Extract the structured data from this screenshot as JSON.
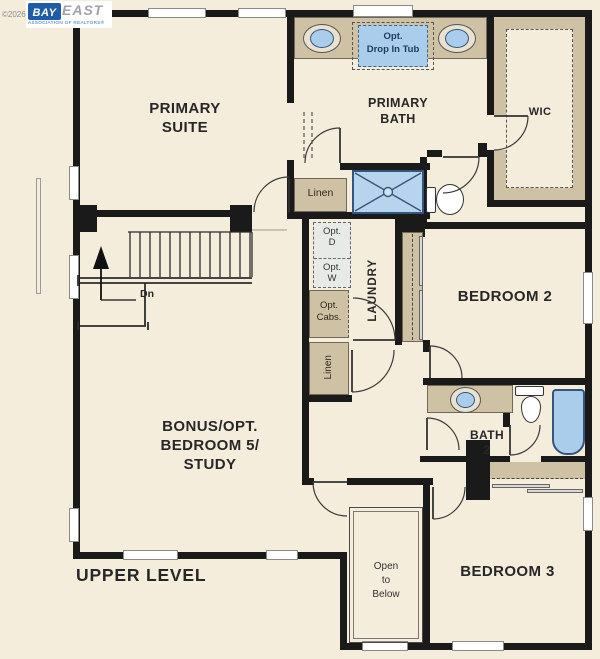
{
  "colors": {
    "background": "#f5eddc",
    "wall": "#1a1a1a",
    "counter_tan": "#cfc2a4",
    "fixture_blue": "#abcdec",
    "fixture_outline": "#35567a",
    "logo_blue": "#1f5ca8",
    "logo_gray": "#9fa3a8",
    "label_color": "#272727"
  },
  "logo": {
    "year": "©2026",
    "brand_primary": "BAY",
    "brand_secondary": "EAST",
    "tagline": "ASSOCIATION OF REALTORS®"
  },
  "level_label": "UPPER LEVEL",
  "rooms": {
    "primary_suite": [
      "PRIMARY",
      "SUITE"
    ],
    "primary_bath": [
      "PRIMARY",
      "BATH"
    ],
    "wic": "WIC",
    "bedroom2": "BEDROOM 2",
    "bath2": [
      "BATH",
      "2"
    ],
    "bedroom3": "BEDROOM 3",
    "bonus": [
      "BONUS/OPT.",
      "BEDROOM 5/",
      "STUDY"
    ],
    "laundry": "LAUNDRY",
    "open_to_below": [
      "Open",
      "to",
      "Below"
    ]
  },
  "closets": {
    "linen_upper": "Linen",
    "linen_lower": "Linen"
  },
  "options": {
    "drop_in_tub": [
      "Opt.",
      "Drop In Tub"
    ],
    "dryer": [
      "Opt.",
      "D"
    ],
    "washer": [
      "Opt.",
      "W"
    ],
    "cabinets": [
      "Opt.",
      "Cabs."
    ]
  },
  "stairs": {
    "down_label": "Dn"
  }
}
